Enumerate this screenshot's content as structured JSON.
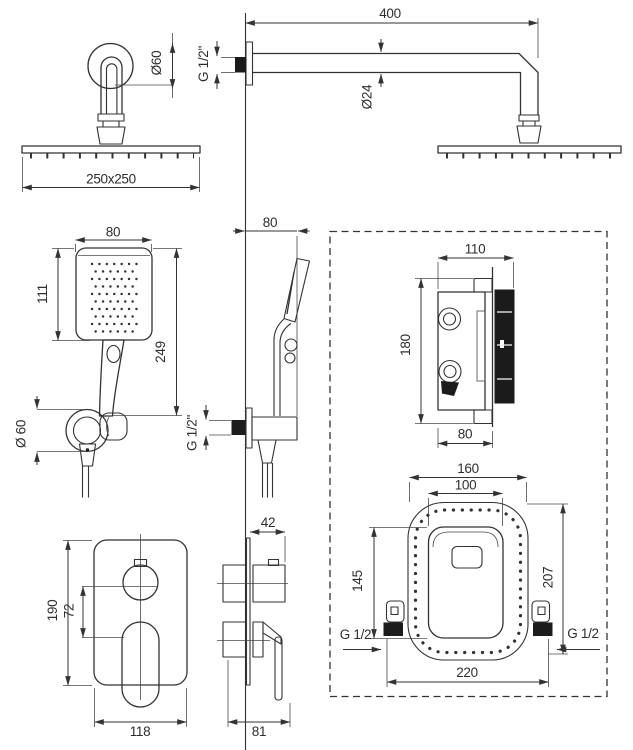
{
  "colors": {
    "line": "#333333",
    "dark_fill": "#1b1b1b",
    "background": "#ffffff"
  },
  "views": {
    "rain_shower_front": {
      "escutcheon_diameter": "Ø60",
      "head_size": "250x250"
    },
    "rain_shower_side": {
      "arm_length": "400",
      "arm_diameter": "Ø24",
      "wall_thread": "G 1/2\""
    },
    "hand_shower_front": {
      "head_width": "80",
      "head_height": "111",
      "length": "249",
      "elbow_diameter": "Ø 60"
    },
    "hand_shower_side": {
      "wall_offset": "80",
      "wall_thread": "G 1/2\""
    },
    "valve_box_side": {
      "total_depth": "110",
      "height": "180",
      "recess_depth": "80"
    },
    "valve_box_front": {
      "cutout_width": "160",
      "cover_width": "100",
      "cover_height": "145",
      "cutout_height": "207",
      "box_width": "220",
      "thread_left": "G 1/2",
      "thread_right": "G 1/2"
    },
    "trim_front": {
      "plate_height": "190",
      "control_spacing": "72",
      "plate_width": "118"
    },
    "trim_side": {
      "knob_depth": "42",
      "total_depth": "81"
    }
  }
}
